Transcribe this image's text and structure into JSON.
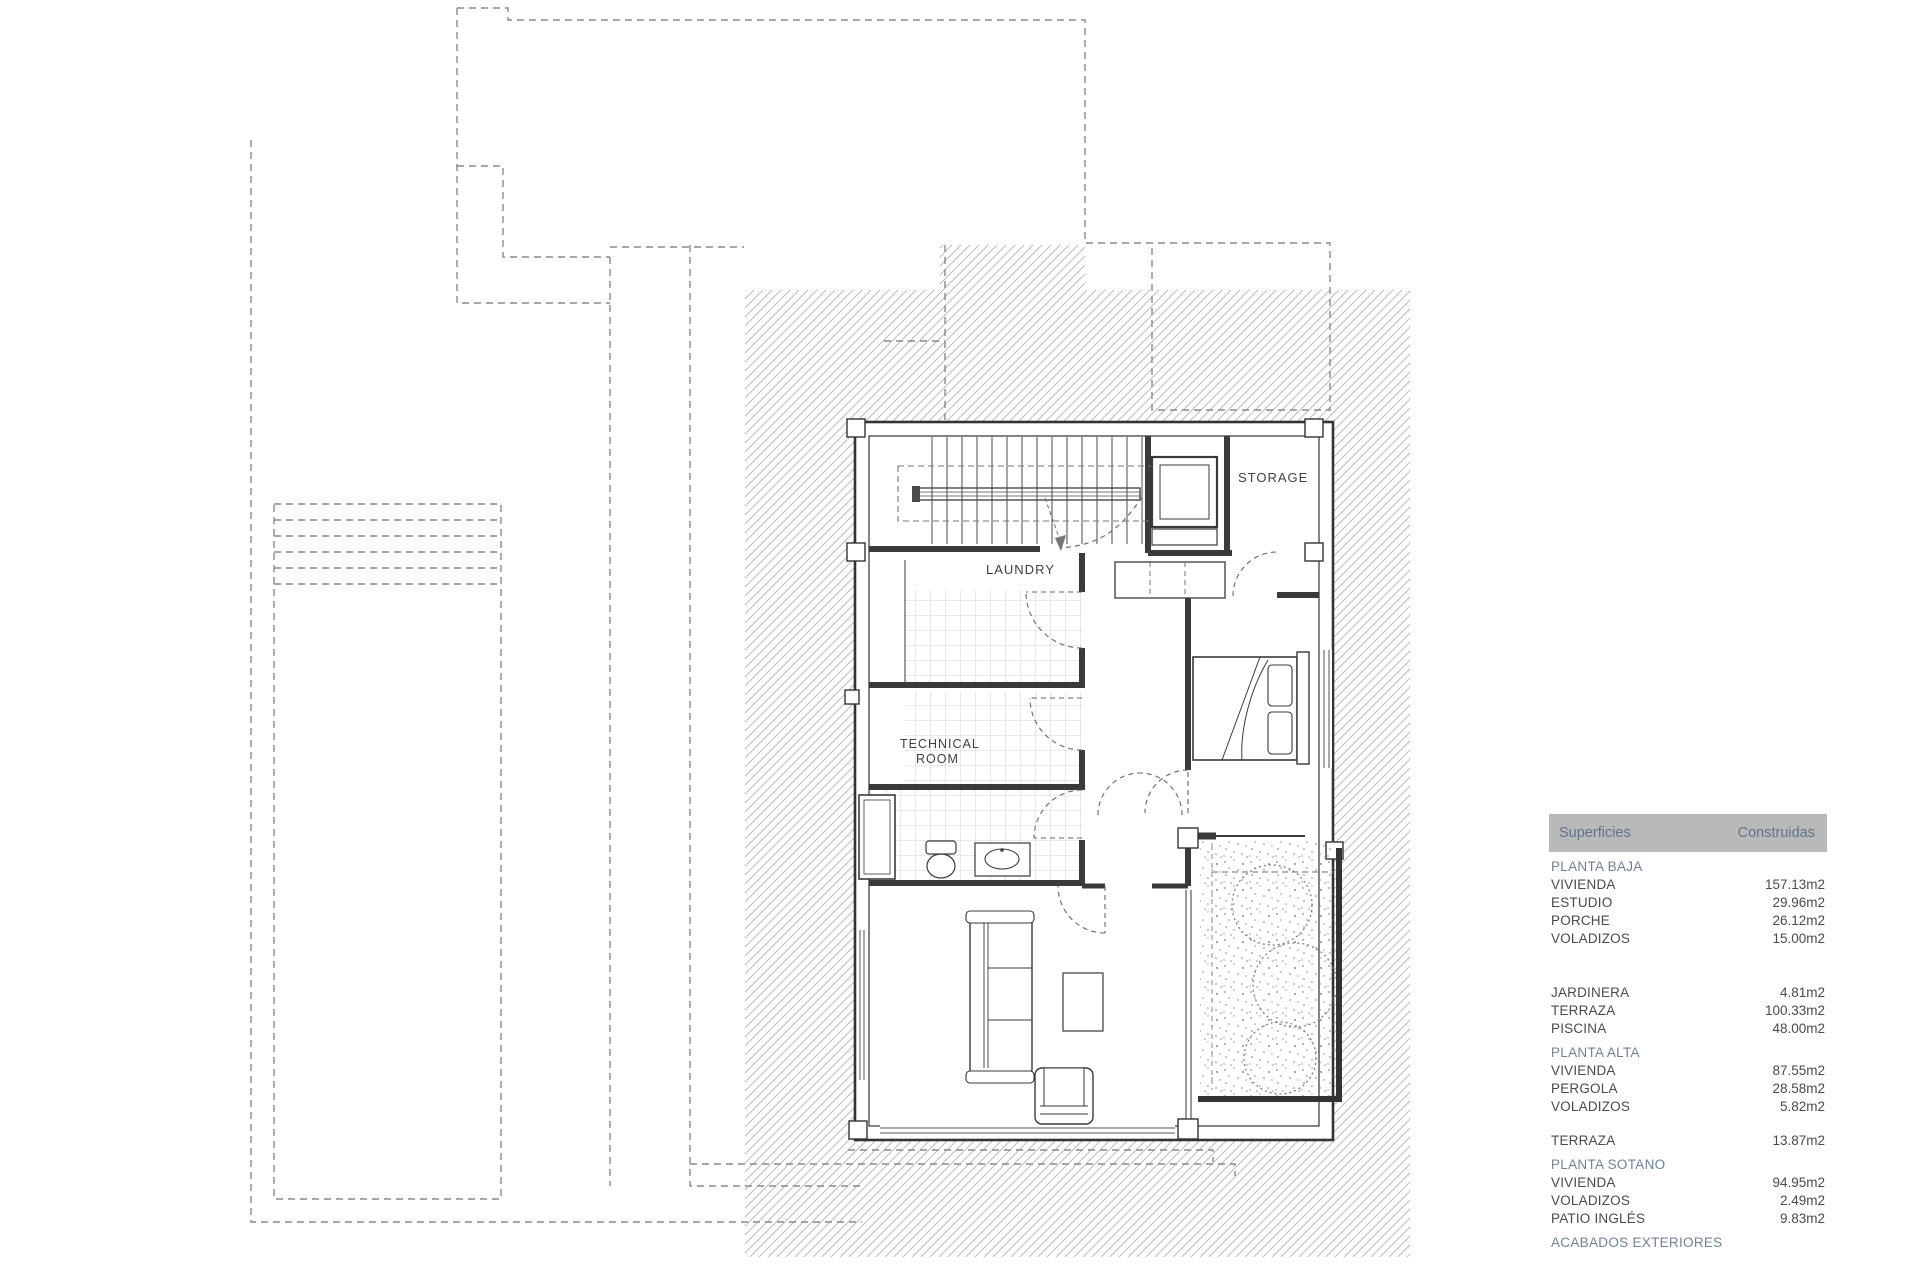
{
  "plan": {
    "room_labels": {
      "storage": "STORAGE",
      "laundry": "LAUNDRY",
      "technical_line1": "TECHNICAL",
      "technical_line2": "ROOM"
    }
  },
  "table": {
    "header": {
      "left": "Superficies",
      "right": "Construidas"
    },
    "blocks": [
      {
        "type": "section",
        "label": "PLANTA BAJA"
      },
      {
        "type": "row",
        "label": "VIVIENDA",
        "value": "157.13m2"
      },
      {
        "type": "row",
        "label": "ESTUDIO",
        "value": "29.96m2"
      },
      {
        "type": "row",
        "label": "PORCHE",
        "value": "26.12m2"
      },
      {
        "type": "row",
        "label": "VOLADIZOS",
        "value": "15.00m2"
      },
      {
        "type": "gap",
        "size": "lg"
      },
      {
        "type": "row",
        "label": "JARDINERA",
        "value": "4.81m2"
      },
      {
        "type": "row",
        "label": "TERRAZA",
        "value": "100.33m2"
      },
      {
        "type": "row",
        "label": "PISCINA",
        "value": "48.00m2"
      },
      {
        "type": "section",
        "label": "PLANTA ALTA"
      },
      {
        "type": "row",
        "label": "VIVIENDA",
        "value": "87.55m2"
      },
      {
        "type": "row",
        "label": "PERGOLA",
        "value": "28.58m2"
      },
      {
        "type": "row",
        "label": "VOLADIZOS",
        "value": "5.82m2"
      },
      {
        "type": "gap",
        "size": "sm"
      },
      {
        "type": "row",
        "label": "TERRAZA",
        "value": "13.87m2"
      },
      {
        "type": "section",
        "label": "PLANTA SOTANO"
      },
      {
        "type": "row",
        "label": "VIVIENDA",
        "value": "94.95m2"
      },
      {
        "type": "row",
        "label": "VOLADIZOS",
        "value": "2.49m2"
      },
      {
        "type": "row",
        "label": "PATIO INGLÉS",
        "value": "9.83m2"
      },
      {
        "type": "section",
        "label": "ACABADOS EXTERIORES"
      }
    ]
  },
  "colors": {
    "accent_blue": "#6f8199",
    "header_bar_bg": "#b9b9b9",
    "header_text": "#5f7390",
    "line_dark": "#3a3a3a",
    "hatch": "#aeaeae",
    "dashed_gray": "#8a8a8a"
  }
}
